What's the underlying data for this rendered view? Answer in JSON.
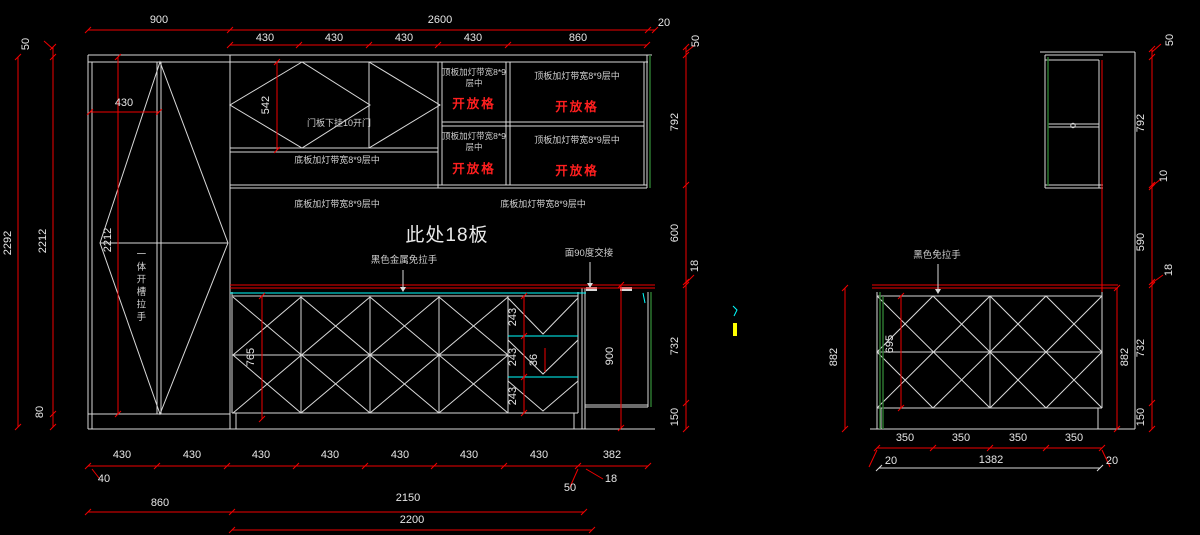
{
  "colors": {
    "background": "#000000",
    "geometry_line": "#d9d9d9",
    "dimension_red": "#f00000",
    "countertop_cyan": "#00ffff",
    "panel_green": "#2f7d32",
    "mark_yellow": "#ffff00",
    "dim_text": "#e6e6e6",
    "red_text": "#ff1f1f"
  },
  "left": {
    "top": {
      "d900": "900",
      "d2600": "2600",
      "d20": "20",
      "segs": [
        "430",
        "430",
        "430",
        "430",
        "860"
      ],
      "d50": "50"
    },
    "side_left": {
      "d50": "50",
      "d2292": "2292",
      "d2212": "2212",
      "d80": "80"
    },
    "inner": {
      "d2212": "2212",
      "d430": "430",
      "d542": "542",
      "d765": "765",
      "d243": [
        "243",
        "243",
        "243"
      ],
      "d36": "36",
      "d900": "900"
    },
    "side_right": {
      "d20": "20",
      "d50": "50",
      "d792": "792",
      "d600": "600",
      "d18": "18",
      "d732": "732",
      "d150": "150"
    },
    "bottom": {
      "row1": [
        "430",
        "430",
        "430",
        "430",
        "430",
        "430",
        "430",
        "382"
      ],
      "d40": "40",
      "d50": "50",
      "d18": "18",
      "d860": "860",
      "d2150": "2150",
      "d2200": "2200"
    },
    "notes": {
      "top_light": "顶板加灯带宽8*9层中",
      "open_cell": "开放格",
      "bottom_light": "底板加灯带宽8*9层中",
      "door_note": "门板下挂10开门",
      "board18": "此处18板",
      "handle": "黑色金属免拉手",
      "joint": "面90度交接",
      "slot_handle": "一体开槽拉手"
    }
  },
  "right": {
    "side_right": {
      "d50": "50",
      "d792": "792",
      "d10": "10",
      "d590": "590",
      "d18": "18",
      "d732": "732",
      "d150": "150"
    },
    "inner": {
      "d882l": "882",
      "d695": "695",
      "d882r": "882"
    },
    "bottom": {
      "row1": [
        "350",
        "350",
        "350",
        "350"
      ],
      "d20l": "20",
      "d1382": "1382",
      "d20r": "20"
    },
    "notes": {
      "handle": "黑色免拉手"
    }
  }
}
